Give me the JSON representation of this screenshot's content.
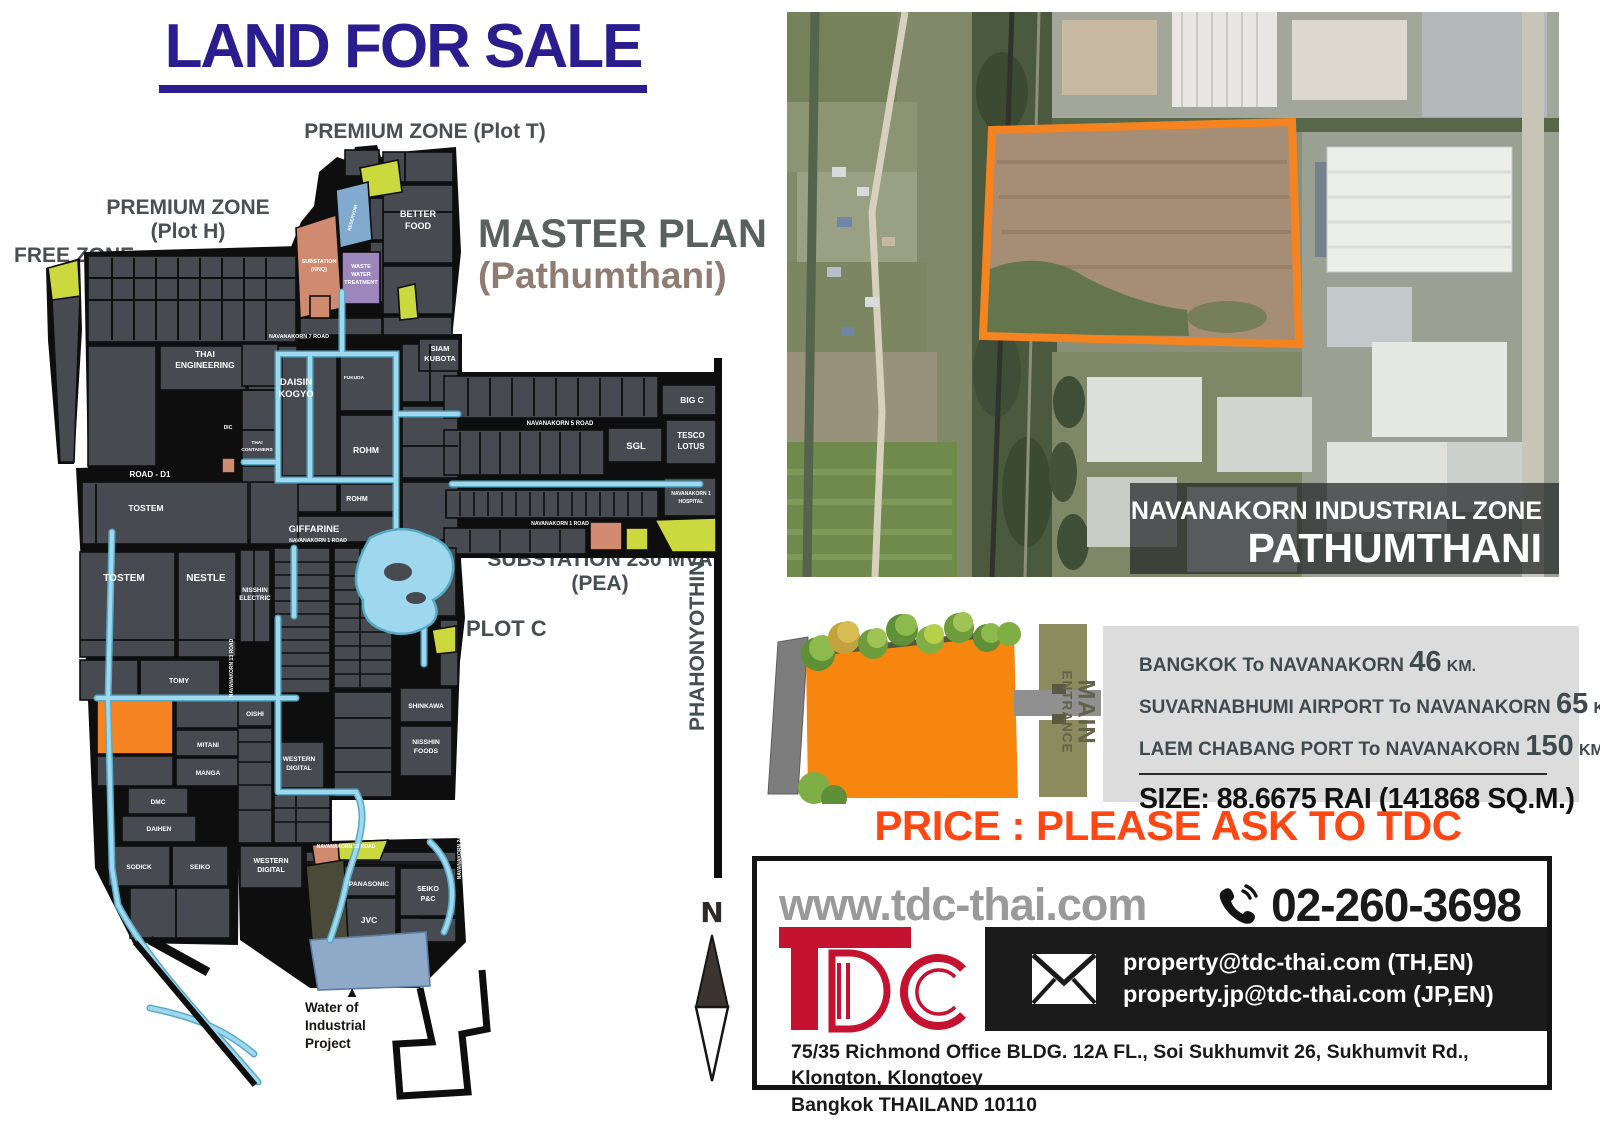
{
  "title": "LAND FOR SALE",
  "colors": {
    "title_navy": "#2b1d8e",
    "price_orange": "#ff4713",
    "land_orange": "#f5831f",
    "plot_gray": "#474a51",
    "canal_blue": "#9fd8ee",
    "tdc_red": "#c41230",
    "info_bg": "#dcdcdc"
  },
  "zones": {
    "premium_t": "PREMIUM ZONE (Plot T)",
    "premium_h_line1": "PREMIUM ZONE",
    "premium_h_line2": "(Plot H)",
    "free_zone": "FREE ZONE",
    "master_plan_line1": "MASTER PLAN",
    "master_plan_line2": "(Pathumthani)",
    "substation_line1": "SUBSTATION 230 MVA",
    "substation_line2": "(PEA)",
    "plot_c": "PLOT C",
    "phahonyothin_road": "PHAHONYOTHIN ROAD",
    "north": "N"
  },
  "map": {
    "labels": [
      {
        "t": "BETTER",
        "x": 418,
        "y": 217,
        "s": 9
      },
      {
        "t": "FOOD",
        "x": 418,
        "y": 229,
        "s": 9
      },
      {
        "t": "SUBSTATION",
        "x": 319,
        "y": 263,
        "s": 5.5
      },
      {
        "t": "(NNQ)",
        "x": 319,
        "y": 271,
        "s": 5.5
      },
      {
        "t": "RESERVOIR",
        "x": 354,
        "y": 218,
        "s": 4.6,
        "r": -75
      },
      {
        "t": "WASTE",
        "x": 361,
        "y": 268,
        "s": 5.5
      },
      {
        "t": "WATER",
        "x": 361,
        "y": 276,
        "s": 5.5
      },
      {
        "t": "TREATMENT",
        "x": 361,
        "y": 284,
        "s": 5.5
      },
      {
        "t": "NAVANAKORN 7 ROAD",
        "x": 299,
        "y": 338,
        "s": 5.4
      },
      {
        "t": "THAI",
        "x": 205,
        "y": 357,
        "s": 8.5
      },
      {
        "t": "ENGINEERING",
        "x": 205,
        "y": 368,
        "s": 8.5
      },
      {
        "t": "SIAM",
        "x": 440,
        "y": 351,
        "s": 7.5
      },
      {
        "t": "KUBOTA",
        "x": 440,
        "y": 361,
        "s": 7.5
      },
      {
        "t": "DAISIN",
        "x": 296,
        "y": 385,
        "s": 9.5
      },
      {
        "t": "KOGYO",
        "x": 296,
        "y": 397,
        "s": 9.5
      },
      {
        "t": "FUKUDA",
        "x": 354,
        "y": 379,
        "s": 4.8
      },
      {
        "t": "DIC",
        "x": 228,
        "y": 429,
        "s": 5
      },
      {
        "t": "THAI",
        "x": 257,
        "y": 444,
        "s": 4.8
      },
      {
        "t": "CONTAINERS",
        "x": 257,
        "y": 451,
        "s": 4.8
      },
      {
        "t": "ROHM",
        "x": 366,
        "y": 453,
        "s": 8.5
      },
      {
        "t": "ROAD - D1",
        "x": 150,
        "y": 477,
        "s": 8
      },
      {
        "t": "TOSTEM",
        "x": 146,
        "y": 511,
        "s": 8.5
      },
      {
        "t": "GIFFARINE",
        "x": 314,
        "y": 532,
        "s": 9.5
      },
      {
        "t": "NAVANAKORN 1 ROAD",
        "x": 318,
        "y": 542,
        "s": 5.2
      },
      {
        "t": "ROHM",
        "x": 357,
        "y": 501,
        "s": 7
      },
      {
        "t": "NAVANAKORN 5 ROAD",
        "x": 560,
        "y": 425,
        "s": 6
      },
      {
        "t": "BIG C",
        "x": 692,
        "y": 403,
        "s": 8.5
      },
      {
        "t": "SGL",
        "x": 636,
        "y": 449,
        "s": 9.5
      },
      {
        "t": "TESCO",
        "x": 691,
        "y": 438,
        "s": 8
      },
      {
        "t": "LOTUS",
        "x": 691,
        "y": 449,
        "s": 8
      },
      {
        "t": "NAVANAKORN 1",
        "x": 691,
        "y": 495,
        "s": 5
      },
      {
        "t": "HOSPITAL",
        "x": 691,
        "y": 503,
        "s": 5
      },
      {
        "t": "NAVANAKORN 1 ROAD",
        "x": 560,
        "y": 525,
        "s": 5.2
      },
      {
        "t": "TOSTEM",
        "x": 124,
        "y": 581,
        "s": 10
      },
      {
        "t": "NESTLE",
        "x": 206,
        "y": 581,
        "s": 10
      },
      {
        "t": "NISSHIN",
        "x": 255,
        "y": 592,
        "s": 6.3
      },
      {
        "t": "ELECTRIC",
        "x": 255,
        "y": 600,
        "s": 6.3
      },
      {
        "t": "NAVANAKORN 13 ROAD",
        "x": 233,
        "y": 668,
        "s": 5,
        "r": -90
      },
      {
        "t": "TOMY",
        "x": 179,
        "y": 683,
        "s": 7
      },
      {
        "t": "OISHI",
        "x": 255,
        "y": 716,
        "s": 6.5
      },
      {
        "t": "MITANI",
        "x": 208,
        "y": 747,
        "s": 6.5
      },
      {
        "t": "MANGA",
        "x": 208,
        "y": 775,
        "s": 6.5
      },
      {
        "t": "WESTERN",
        "x": 299,
        "y": 761,
        "s": 6.5
      },
      {
        "t": "DIGITAL",
        "x": 299,
        "y": 770,
        "s": 6.5
      },
      {
        "t": "DMC",
        "x": 158,
        "y": 804,
        "s": 6.5
      },
      {
        "t": "DAIHEN",
        "x": 159,
        "y": 831,
        "s": 6.5
      },
      {
        "t": "SODICK",
        "x": 139,
        "y": 869,
        "s": 6.5
      },
      {
        "t": "SEIKO",
        "x": 200,
        "y": 869,
        "s": 6.5
      },
      {
        "t": "SHINKAWA",
        "x": 426,
        "y": 708,
        "s": 6.6
      },
      {
        "t": "NISSHIN",
        "x": 426,
        "y": 744,
        "s": 6.8
      },
      {
        "t": "FOODS",
        "x": 426,
        "y": 753,
        "s": 6.8
      },
      {
        "t": "WESTERN",
        "x": 271,
        "y": 863,
        "s": 7
      },
      {
        "t": "DIGITAL",
        "x": 271,
        "y": 872,
        "s": 7
      },
      {
        "t": "NAVANAKORN 13 ROAD",
        "x": 346,
        "y": 848,
        "s": 5
      },
      {
        "t": "PANASONIC",
        "x": 369,
        "y": 886,
        "s": 6.8
      },
      {
        "t": "JVC",
        "x": 369,
        "y": 923,
        "s": 8.5
      },
      {
        "t": "SEIKO",
        "x": 428,
        "y": 891,
        "s": 7
      },
      {
        "t": "P&C",
        "x": 428,
        "y": 901,
        "s": 7
      },
      {
        "t": "NAVANAKORN 24 ROAD",
        "x": 461,
        "y": 850,
        "s": 5,
        "r": -90
      },
      {
        "t": "▲",
        "x": 352,
        "y": 997,
        "s": 15,
        "c": "#15120f"
      },
      {
        "t": "Water of",
        "x": 305,
        "y": 1012,
        "s": 13.5,
        "c": "#15120f",
        "a": "start",
        "w": 600
      },
      {
        "t": "Industrial",
        "x": 305,
        "y": 1030,
        "s": 13.5,
        "c": "#15120f",
        "a": "start",
        "w": 600
      },
      {
        "t": "Project",
        "x": 305,
        "y": 1048,
        "s": 13.5,
        "c": "#15120f",
        "a": "start",
        "w": 600
      }
    ]
  },
  "satellite": {
    "overlay_line1": "NAVANAKORN INDUSTRIAL ZONE",
    "overlay_line2": "PATHUMTHANI"
  },
  "entrance": {
    "label1": "MAIN",
    "label2": "ENTRANCE"
  },
  "info": {
    "rows": [
      {
        "place": "BANGKOK To NAVANAKORN",
        "value": "46",
        "unit": "KM."
      },
      {
        "place": "SUVARNABHUMI AIRPORT To NAVANAKORN",
        "value": "65",
        "unit": "KM."
      },
      {
        "place": "LAEM CHABANG PORT To NAVANAKORN",
        "value": "150",
        "unit": "KM."
      }
    ],
    "size": "SIZE: 88.6675 RAI (141868 SQ.M.)"
  },
  "price": "PRICE : PLEASE ASK TO TDC",
  "contact": {
    "website": "www.tdc-thai.com",
    "phone": "02-260-3698",
    "email1": "property@tdc-thai.com (TH,EN)",
    "email2": "property.jp@tdc-thai.com (JP,EN)",
    "address_line1": "75/35 Richmond Office BLDG. 12A FL., Soi Sukhumvit 26, Sukhumvit Rd., Klongton, Klongtoey",
    "address_line2": "Bangkok THAILAND 10110"
  }
}
